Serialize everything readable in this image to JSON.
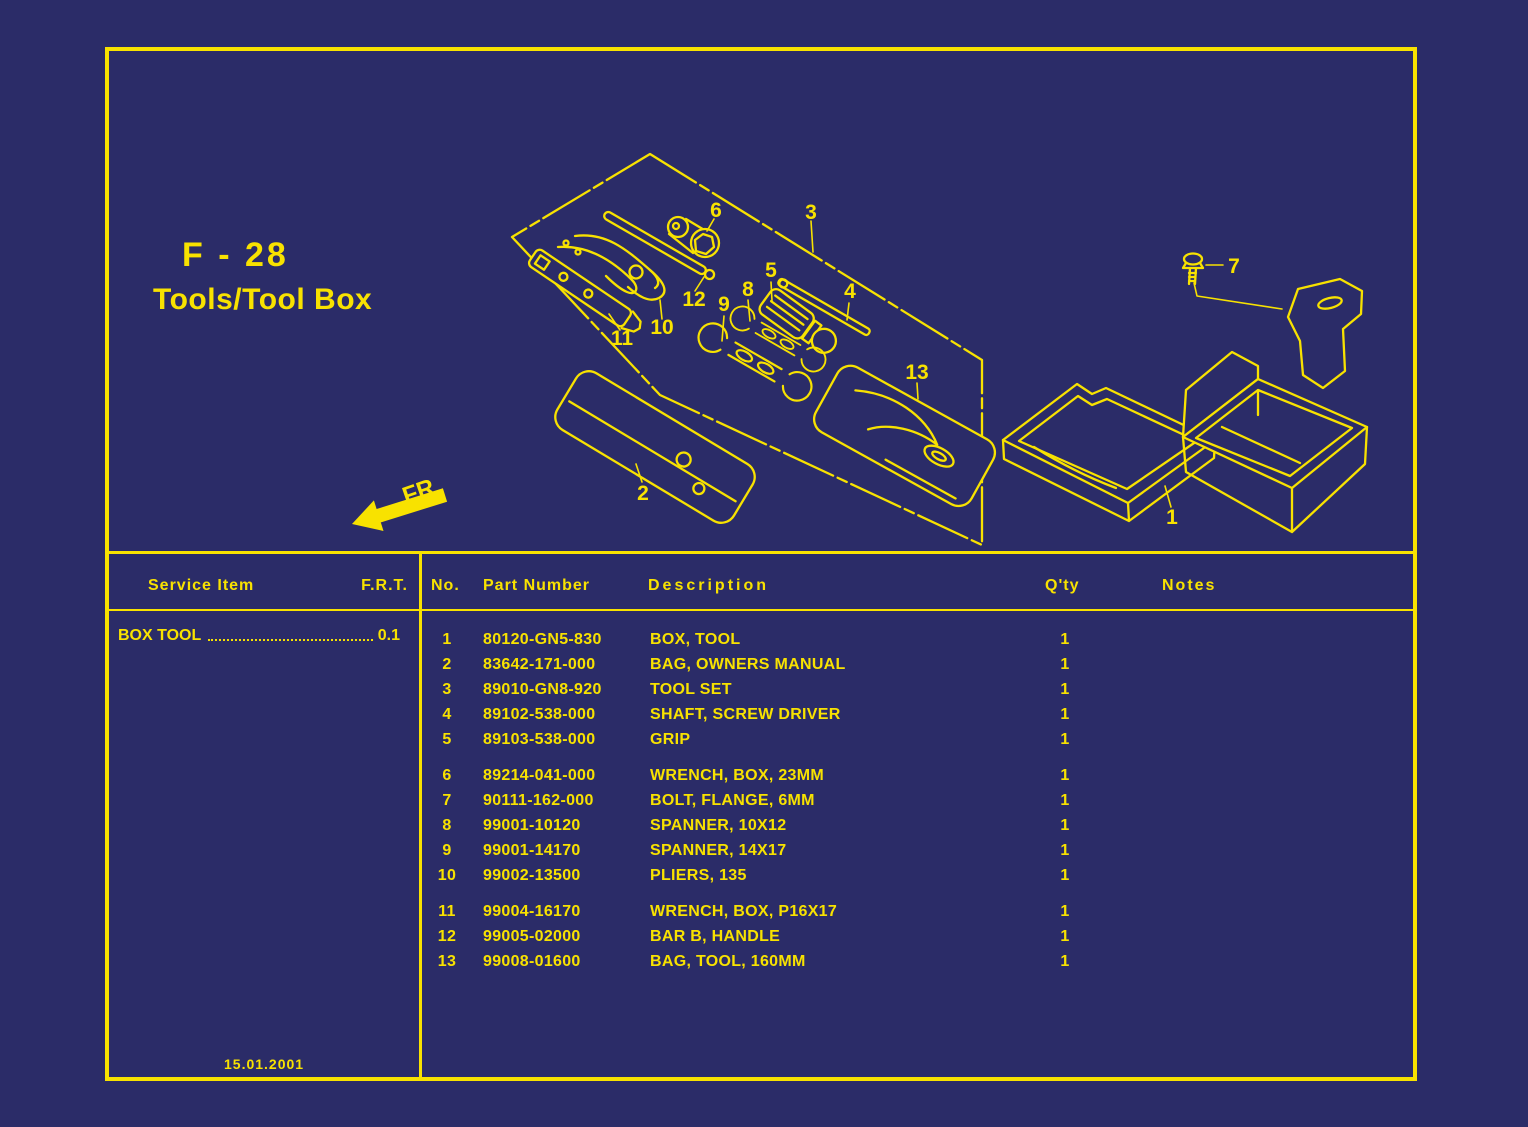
{
  "colors": {
    "background": "#2b2c68",
    "ink": "#f8e200"
  },
  "header": {
    "page_code": "F - 28",
    "page_title": "Tools/Tool Box",
    "fr_label": "FR",
    "revision_date": "15.01.2001"
  },
  "service_panel": {
    "item_header": "Service Item",
    "frt_header": "F.R.T.",
    "rows": [
      {
        "item": "BOX TOOL",
        "frt": "0.1"
      }
    ]
  },
  "parts_table": {
    "headers": {
      "no": "No.",
      "part_number": "Part Number",
      "description": "Description",
      "qty": "Q'ty",
      "notes": "Notes"
    },
    "rows": [
      {
        "no": "1",
        "part_number": "80120-GN5-830",
        "description": "BOX, TOOL",
        "qty": "1",
        "notes": "",
        "group": 1
      },
      {
        "no": "2",
        "part_number": "83642-171-000",
        "description": "BAG, OWNERS MANUAL",
        "qty": "1",
        "notes": "",
        "group": 1
      },
      {
        "no": "3",
        "part_number": "89010-GN8-920",
        "description": "TOOL SET",
        "qty": "1",
        "notes": "",
        "group": 1
      },
      {
        "no": "4",
        "part_number": "89102-538-000",
        "description": "SHAFT, SCREW DRIVER",
        "qty": "1",
        "notes": "",
        "group": 1
      },
      {
        "no": "5",
        "part_number": "89103-538-000",
        "description": "GRIP",
        "qty": "1",
        "notes": "",
        "group": 1
      },
      {
        "no": "6",
        "part_number": "89214-041-000",
        "description": "WRENCH, BOX, 23MM",
        "qty": "1",
        "notes": "",
        "group": 2
      },
      {
        "no": "7",
        "part_number": "90111-162-000",
        "description": "BOLT, FLANGE, 6MM",
        "qty": "1",
        "notes": "",
        "group": 2
      },
      {
        "no": "8",
        "part_number": "99001-10120",
        "description": "SPANNER, 10X12",
        "qty": "1",
        "notes": "",
        "group": 2
      },
      {
        "no": "9",
        "part_number": "99001-14170",
        "description": "SPANNER, 14X17",
        "qty": "1",
        "notes": "",
        "group": 2
      },
      {
        "no": "10",
        "part_number": "99002-13500",
        "description": "PLIERS, 135",
        "qty": "1",
        "notes": "",
        "group": 2
      },
      {
        "no": "11",
        "part_number": "99004-16170",
        "description": "WRENCH, BOX, P16X17",
        "qty": "1",
        "notes": "",
        "group": 3
      },
      {
        "no": "12",
        "part_number": "99005-02000",
        "description": "BAR B, HANDLE",
        "qty": "1",
        "notes": "",
        "group": 3
      },
      {
        "no": "13",
        "part_number": "99008-01600",
        "description": "BAG, TOOL, 160MM",
        "qty": "1",
        "notes": "",
        "group": 3
      }
    ]
  },
  "diagram": {
    "callouts": {
      "c1": "1",
      "c2": "2",
      "c3": "3",
      "c4": "4",
      "c5": "5",
      "c6": "6",
      "c7": "7",
      "c8": "8",
      "c9": "9",
      "c10": "10",
      "c11": "11",
      "c12": "12",
      "c13": "13"
    }
  }
}
